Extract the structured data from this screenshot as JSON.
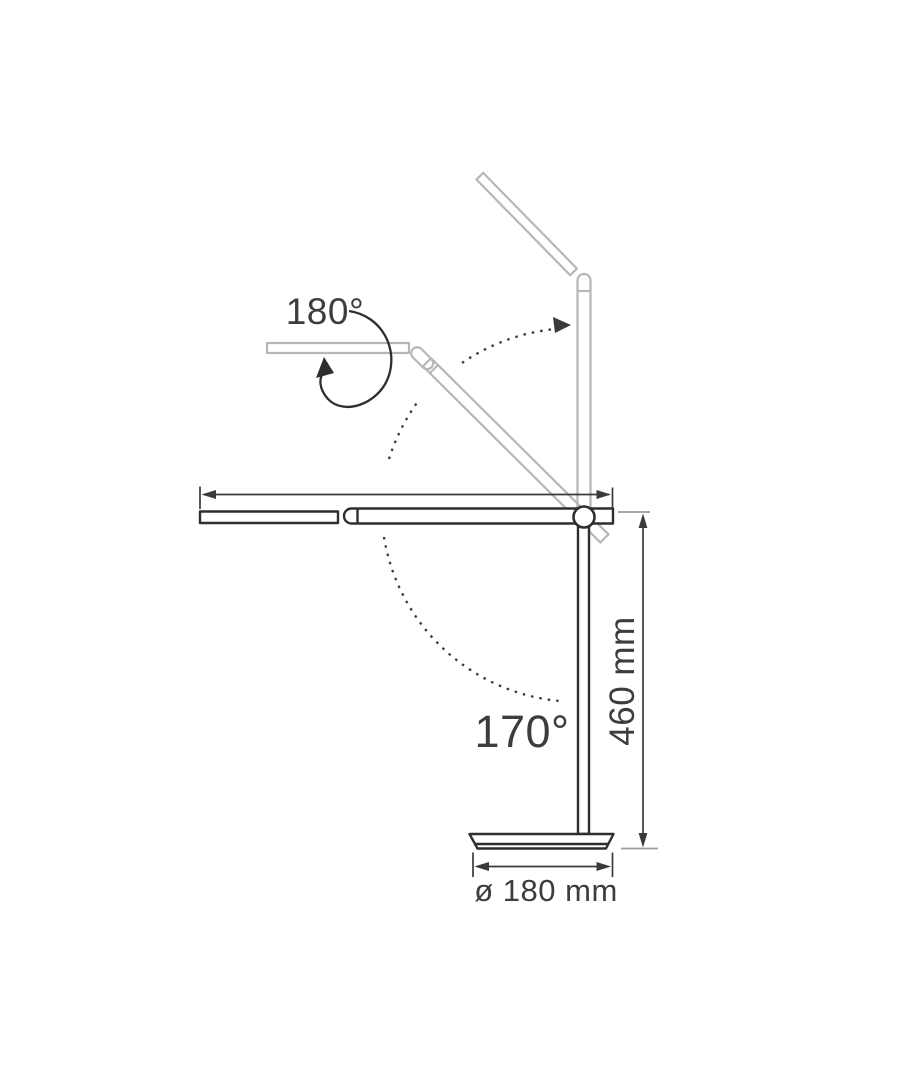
{
  "diagram": {
    "subject": "desk-lamp articulation and dimension drawing",
    "labels": {
      "head_rotation": "180°",
      "arm_rotation": "170°",
      "lamp_height": "460 mm",
      "base_diameter": "ø 180 mm"
    },
    "colors": {
      "background": "#ffffff",
      "lamp_outline": "#2e2e2e",
      "ghost_outline": "#b7b7b7",
      "dimension_line": "#3a3a3a",
      "reference_tick": "#9c9c9c",
      "label_text": "#3d3d3d"
    }
  }
}
